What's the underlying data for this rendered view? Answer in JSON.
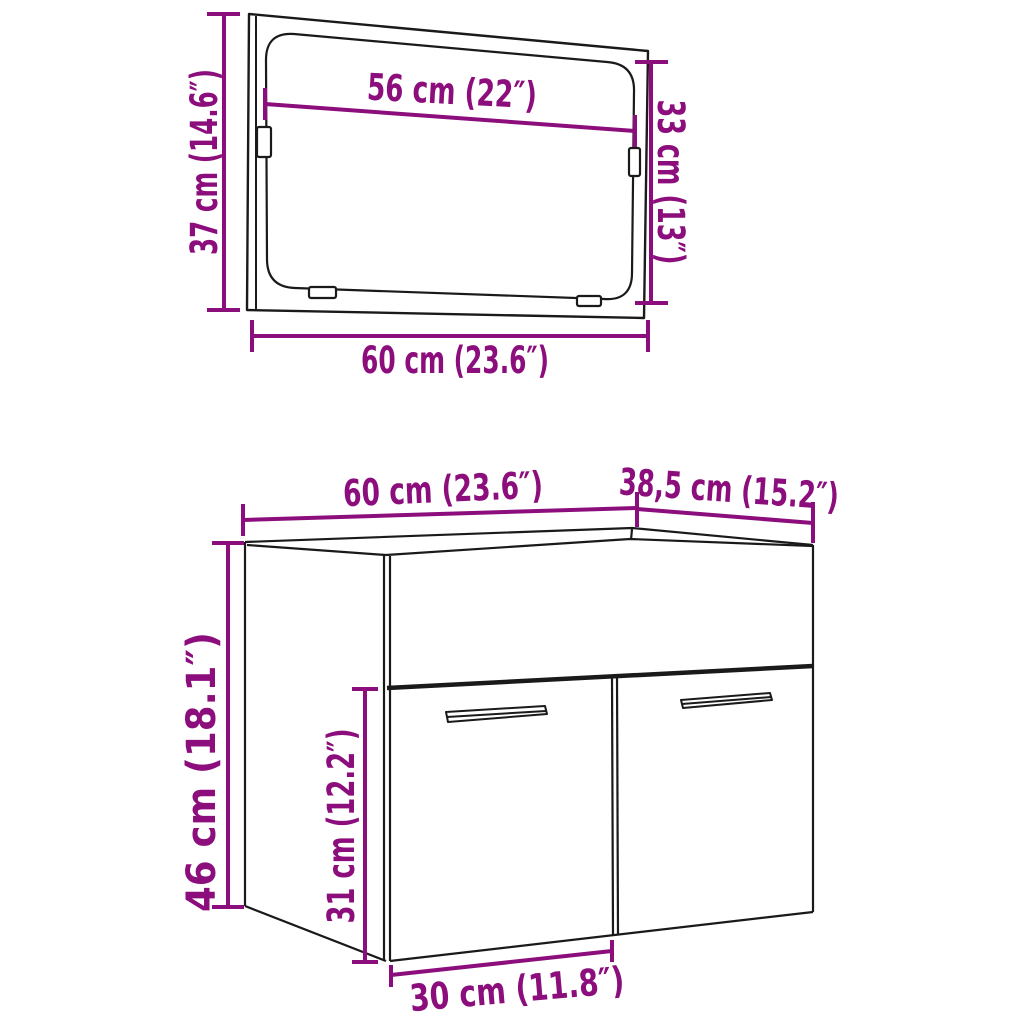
{
  "colors": {
    "dimension": "#8C0D7C",
    "line": "#1a1a1a",
    "background": "#ffffff"
  },
  "mirror": {
    "height_label": "37 cm (14.6″)",
    "glass_width_label": "56 cm (22″)",
    "glass_height_label": "33 cm (13″)",
    "width_label": "60 cm (23.6″)"
  },
  "cabinet": {
    "width_label": "60 cm (23.6″)",
    "depth_label": "38,5 cm (15.2″)",
    "height_label": "46 cm (18.1″)",
    "door_height_label": "31 cm (12.2″)",
    "door_width_label": "30 cm (11.8″)"
  }
}
